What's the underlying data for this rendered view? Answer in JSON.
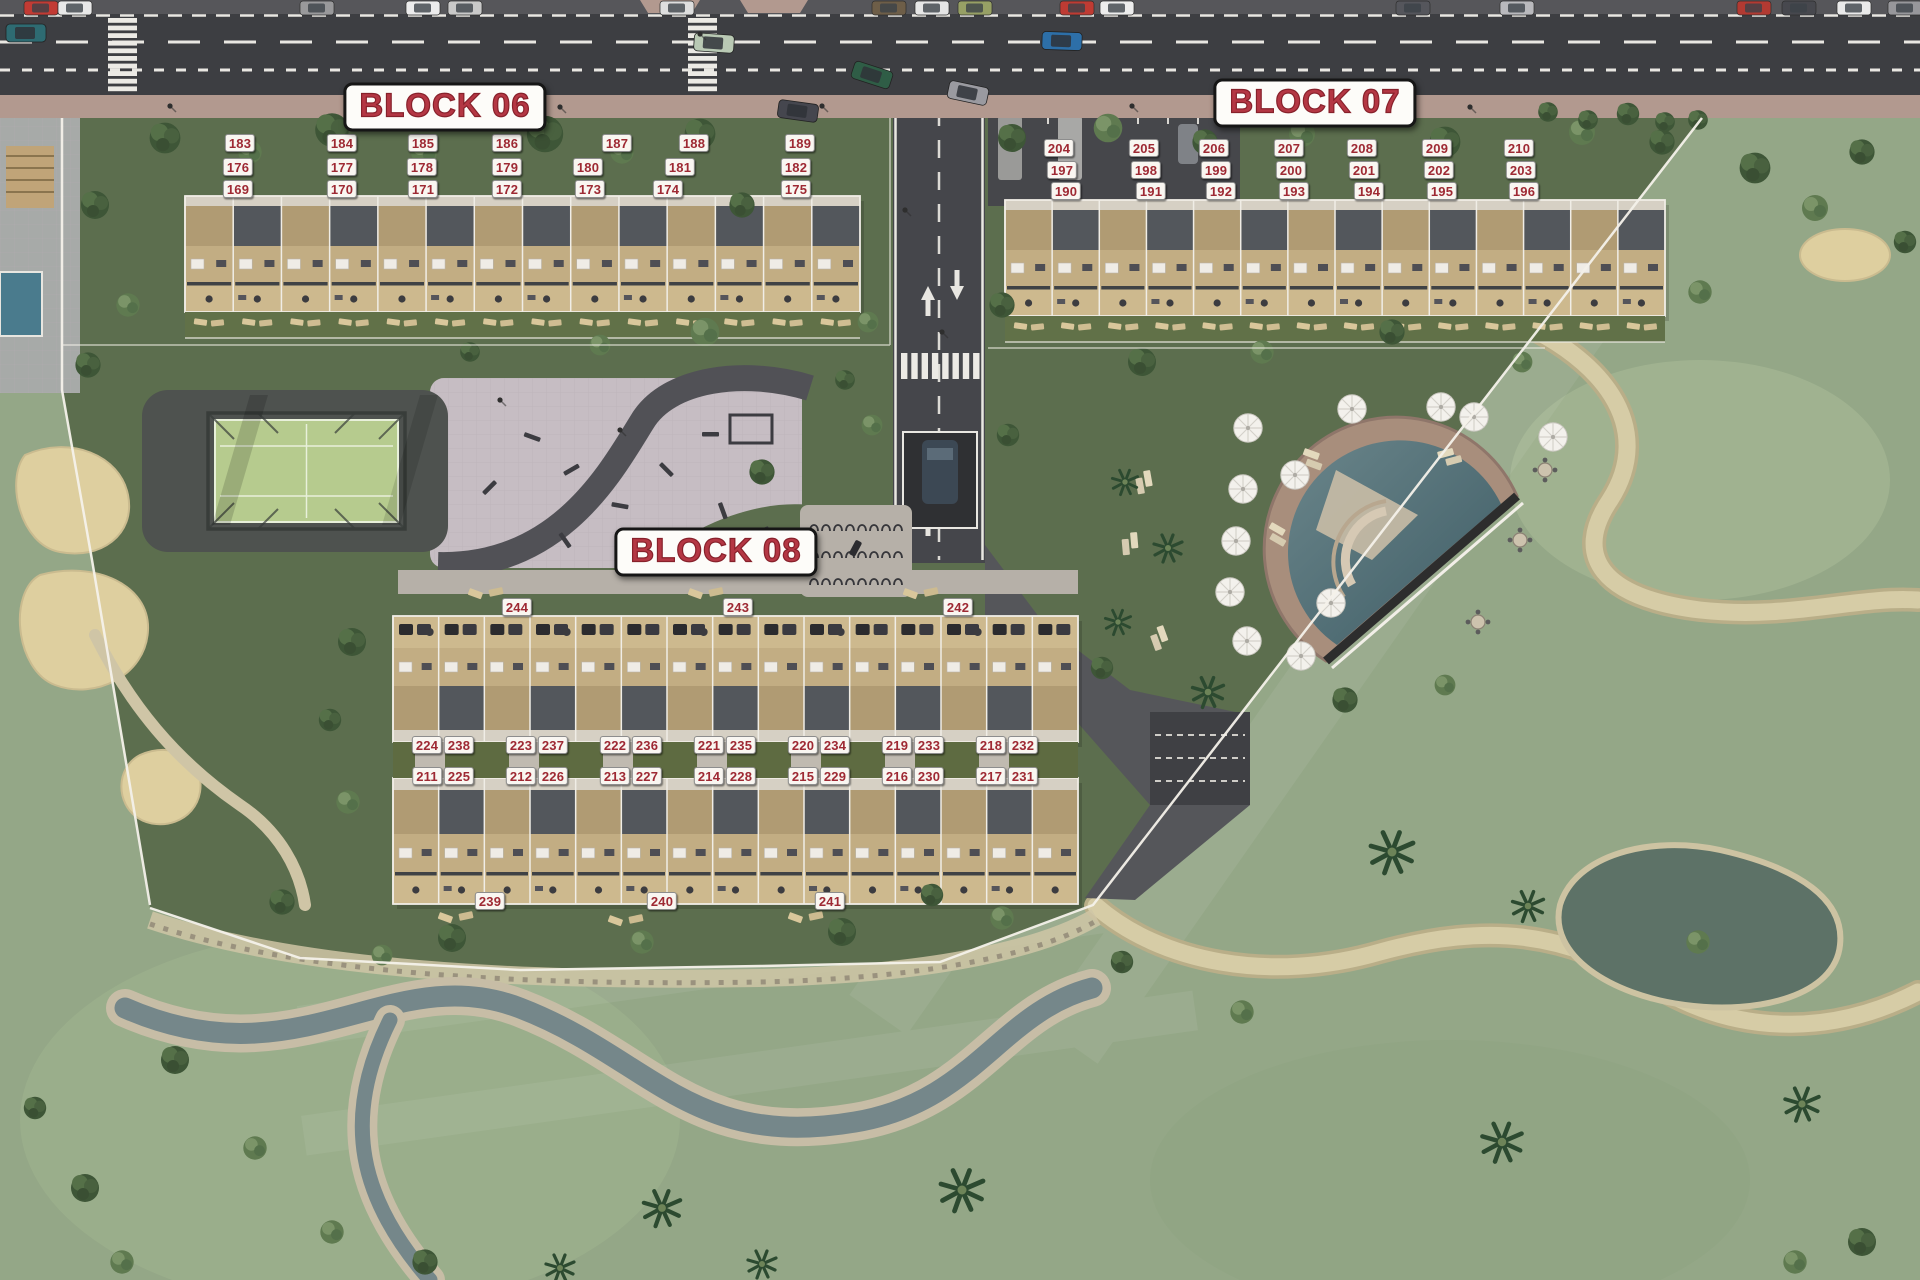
{
  "block_titles": [
    {
      "id": "block-06",
      "text": "BLOCK 06",
      "x": 445,
      "y": 107
    },
    {
      "id": "block-07",
      "text": "BLOCK 07",
      "x": 1315,
      "y": 103
    },
    {
      "id": "block-08",
      "text": "BLOCK 08",
      "x": 716,
      "y": 552
    }
  ],
  "unit_labels": {
    "block06": [
      [
        "183",
        240,
        143
      ],
      [
        "184",
        342,
        143
      ],
      [
        "185",
        423,
        143
      ],
      [
        "186",
        507,
        143
      ],
      [
        "187",
        617,
        143
      ],
      [
        "188",
        694,
        143
      ],
      [
        "189",
        800,
        143
      ],
      [
        "176",
        238,
        167
      ],
      [
        "177",
        342,
        167
      ],
      [
        "178",
        422,
        167
      ],
      [
        "179",
        507,
        167
      ],
      [
        "180",
        588,
        167
      ],
      [
        "181",
        680,
        167
      ],
      [
        "182",
        796,
        167
      ],
      [
        "169",
        238,
        189
      ],
      [
        "170",
        342,
        189
      ],
      [
        "171",
        423,
        189
      ],
      [
        "172",
        507,
        189
      ],
      [
        "173",
        590,
        189
      ],
      [
        "174",
        668,
        189
      ],
      [
        "175",
        796,
        189
      ]
    ],
    "block07": [
      [
        "204",
        1059,
        148
      ],
      [
        "205",
        1144,
        148
      ],
      [
        "206",
        1214,
        148
      ],
      [
        "207",
        1289,
        148
      ],
      [
        "208",
        1362,
        148
      ],
      [
        "209",
        1437,
        148
      ],
      [
        "210",
        1519,
        148
      ],
      [
        "197",
        1062,
        170
      ],
      [
        "198",
        1146,
        170
      ],
      [
        "199",
        1216,
        170
      ],
      [
        "200",
        1291,
        170
      ],
      [
        "201",
        1364,
        170
      ],
      [
        "202",
        1439,
        170
      ],
      [
        "203",
        1521,
        170
      ],
      [
        "190",
        1066,
        191
      ],
      [
        "191",
        1151,
        191
      ],
      [
        "192",
        1221,
        191
      ],
      [
        "193",
        1294,
        191
      ],
      [
        "194",
        1369,
        191
      ],
      [
        "195",
        1442,
        191
      ],
      [
        "196",
        1524,
        191
      ]
    ],
    "block08": [
      [
        "244",
        517,
        607
      ],
      [
        "243",
        738,
        607
      ],
      [
        "242",
        958,
        607
      ],
      [
        "224",
        427,
        745
      ],
      [
        "238",
        459,
        745
      ],
      [
        "223",
        521,
        745
      ],
      [
        "237",
        553,
        745
      ],
      [
        "222",
        615,
        745
      ],
      [
        "236",
        647,
        745
      ],
      [
        "221",
        709,
        745
      ],
      [
        "235",
        741,
        745
      ],
      [
        "220",
        803,
        745
      ],
      [
        "234",
        835,
        745
      ],
      [
        "219",
        897,
        745
      ],
      [
        "233",
        929,
        745
      ],
      [
        "218",
        991,
        745
      ],
      [
        "232",
        1023,
        745
      ],
      [
        "211",
        427,
        776
      ],
      [
        "225",
        459,
        776
      ],
      [
        "212",
        521,
        776
      ],
      [
        "226",
        553,
        776
      ],
      [
        "213",
        615,
        776
      ],
      [
        "227",
        647,
        776
      ],
      [
        "214",
        709,
        776
      ],
      [
        "228",
        741,
        776
      ],
      [
        "215",
        803,
        776
      ],
      [
        "229",
        835,
        776
      ],
      [
        "216",
        897,
        776
      ],
      [
        "230",
        929,
        776
      ],
      [
        "217",
        991,
        776
      ],
      [
        "231",
        1023,
        776
      ],
      [
        "239",
        490,
        901
      ],
      [
        "240",
        662,
        901
      ],
      [
        "241",
        830,
        901
      ]
    ]
  },
  "colors": {
    "label_text": "#9e2933",
    "label_bg": "#f9f6f1",
    "title_text": "#b43744",
    "title_outline": "#87212b",
    "plate_bg": "#fdfcf9",
    "road": "#3d3e42",
    "sidewalk": "#b2998f",
    "resort_lawn": "#5c6e4e",
    "golf_grass": "#97aa88",
    "building_wood": "#c2ad83",
    "roof_gray": "#53575c",
    "pool_water": "#4e6d75",
    "pool_deck": "#a88e7c",
    "sand": "#decf9f",
    "padel_turf": "#b6cb8e",
    "plaza": "#c6bdc3",
    "stream_water": "#75878a"
  }
}
